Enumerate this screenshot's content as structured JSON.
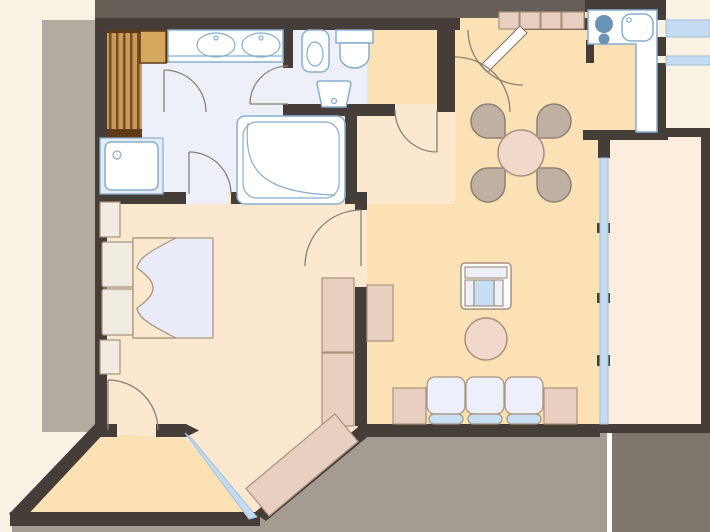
{
  "scene": {
    "type": "apartment-floor-plan",
    "canvas": {
      "width": 710,
      "height": 532
    },
    "rooms": [
      {
        "name": "bathroom",
        "fixtures": [
          "sauna",
          "double-sink-vanity",
          "shower",
          "corner-bathtub"
        ]
      },
      {
        "name": "wc",
        "fixtures": [
          "bidet",
          "toilet",
          "hand-basin"
        ]
      },
      {
        "name": "kitchen",
        "fixtures": [
          "cooktop",
          "kitchen-sink",
          "counter",
          "upper-cabinets"
        ]
      },
      {
        "name": "living-dining",
        "furniture": [
          "dining-table",
          "four-chairs",
          "armchair",
          "coffee-table",
          "sofa",
          "side-tables"
        ]
      },
      {
        "name": "bedroom",
        "furniture": [
          "double-bed",
          "nightstands",
          "pillows",
          "wardrobe"
        ]
      },
      {
        "name": "entry-hall",
        "furniture": [
          "hall-cabinet"
        ]
      },
      {
        "name": "terrace"
      },
      {
        "name": "balcony"
      }
    ]
  },
  "colors": {
    "page_bg": "#FAF2E3",
    "gray_top": "#665F58",
    "gray_left": "#B3AAA1",
    "gray_bottom": "#A49B92",
    "gray_dark": "#7E766D",
    "seam": "#FFFFFF",
    "wall": "#453E38",
    "floor_bath": "#EDF0F8",
    "floor_warm": "#FBE1B3",
    "floor_soft": "#FBE8CE",
    "floor_balcony": "#FCEEDC",
    "window_glass": "#C4DCF2",
    "window_stroke": "#9FBEDC",
    "fixture_fill": "#FFFFFF",
    "fixture_stroke": "#87AECE",
    "shower_tray": "#E3EDF7",
    "burner_blue": "#6C93B6",
    "furn_pink": "#E9CFBF",
    "furn_stroke": "#A8917C",
    "chair_tan": "#BFB1A1",
    "chair_stroke": "#8D8174",
    "table_pink": "#F0D8CB",
    "cushion": "#EDF0FA",
    "seat_blue": "#C7DFF3",
    "mattress": "#E9ECF7",
    "linen": "#F1ECE1",
    "wood_dark": "#5E3B16",
    "wood_slat": "#C99A5C",
    "wood_gap": "#7A4E1E",
    "wood_bench": "#D6A75E",
    "door_stroke": "#8A8075"
  }
}
